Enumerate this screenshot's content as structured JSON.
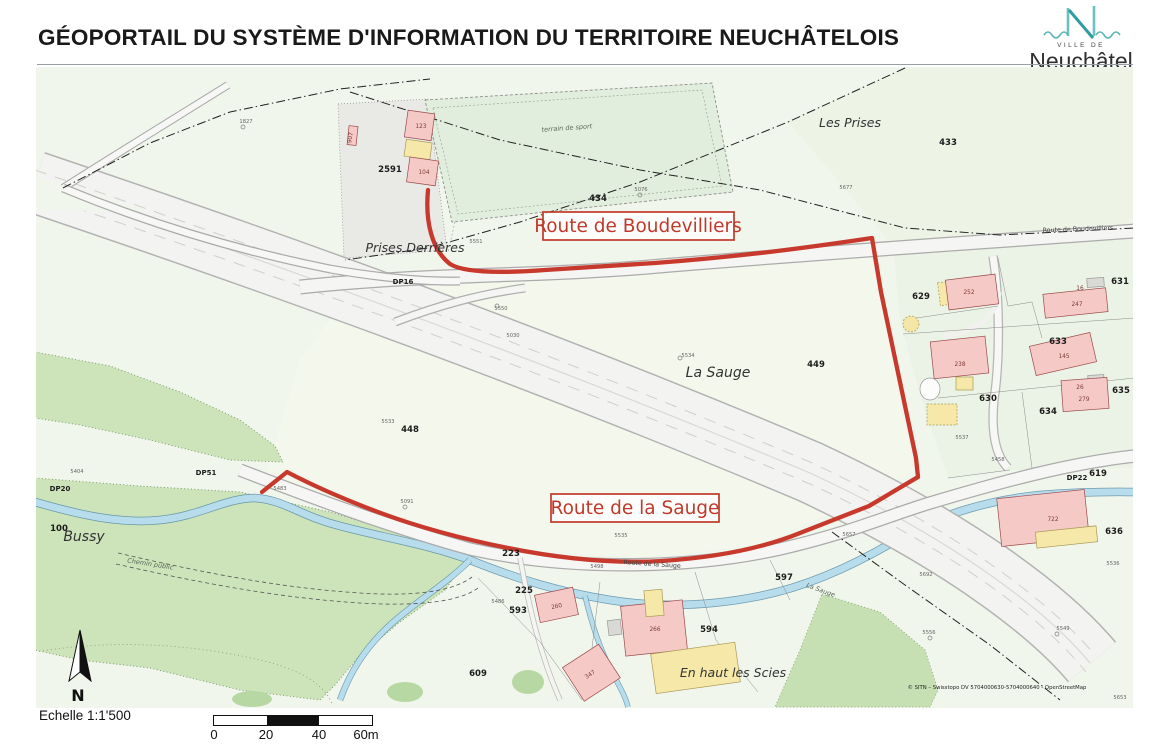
{
  "header": {
    "title": "GÉOPORTAIL DU SYSTÈME D'INFORMATION DU TERRITOIRE NEUCHÂTELOIS",
    "logo": {
      "ville": "VILLE DE",
      "city": "Neuchâtel"
    }
  },
  "routes": {
    "boudevilliers": "Route de Boudevilliers",
    "sauge": "Route de la Sauge",
    "highlight_color": "#c7392c"
  },
  "map": {
    "places": {
      "les_prises": "Les Prises",
      "prises_derrieres": "Prises Derrières",
      "la_sauge": "La Sauge",
      "bussy": "Bussy",
      "en_haut_les_scies": "En haut les Scies",
      "terrain_de_sport": "terrain de sport",
      "chemin_public": "Chemin public",
      "la_sauge_stream": "La Sauge"
    },
    "streets": {
      "route_de_boudevilliers": "Route de Boudevilliers",
      "route_de_la_sauge": "Route de la Sauge"
    },
    "parcels": {
      "p433": "433",
      "p434": "434",
      "p2591": "2591",
      "p448": "448",
      "p449": "449",
      "p629": "629",
      "p630": "630",
      "p631": "631",
      "p633": "633",
      "p634": "634",
      "p635": "635",
      "p636": "636",
      "p619": "619",
      "p609": "609",
      "p593": "593",
      "p594": "594",
      "p597": "597",
      "p223": "223",
      "p225": "225",
      "p100": "100"
    },
    "road_ids": {
      "dp16": "DP16",
      "dp20": "DP20",
      "dp51": "DP51",
      "dp22": "DP22"
    },
    "buildings": {
      "b123": "123",
      "b104": "104",
      "b907": "907",
      "b252": "252",
      "b16": "16",
      "b247": "247",
      "b238": "238",
      "b145": "145",
      "b26": "26",
      "b279": "279",
      "b260": "260",
      "b266": "266",
      "b347": "347",
      "b722": "722"
    },
    "points": {
      "s1827": "1827",
      "s5551": "5551",
      "s5550": "5550",
      "s5534": "5534",
      "s5076": "5076",
      "s5677": "5677",
      "s5533": "5533",
      "s5030": "5030",
      "s5483": "5483",
      "s5091": "5091",
      "s5404": "5404",
      "s5486": "5486",
      "s5498": "5498",
      "s5535": "5535",
      "s5537": "5537",
      "s5458": "5458",
      "s5657": "5657",
      "s5692": "5692",
      "s5536": "5536",
      "s5549": "5549",
      "s5556": "5556",
      "s5653": "5653"
    },
    "north": "N",
    "attribution": "© SITN – Swisstopo DV 5704000630-5704000640 - OpenStreetMap",
    "colors": {
      "forest": "#cde4bb",
      "water": "#b7dcec",
      "building_pink": "#f5c9c6",
      "building_yellow": "#f6e8a8",
      "road_fill": "#f5f5f3"
    }
  },
  "footer": {
    "scale_label": "Echelle 1:1'500",
    "ticks": [
      "0",
      "20",
      "40",
      "60m"
    ]
  }
}
